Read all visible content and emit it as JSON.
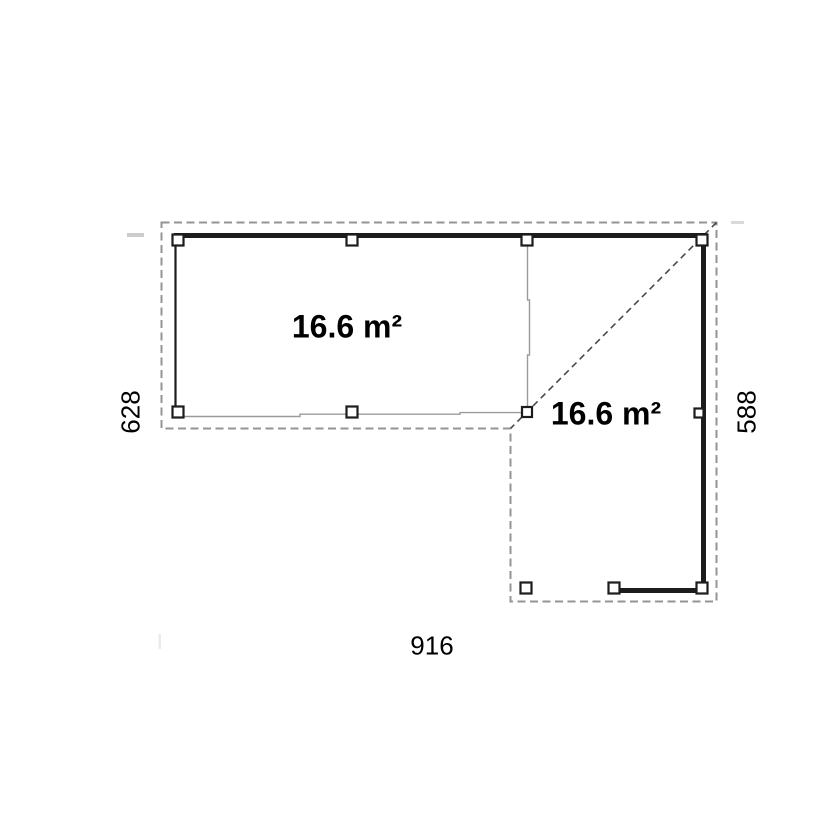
{
  "plan": {
    "area_labels": [
      {
        "text": "16.6 m²"
      },
      {
        "text": "16.6 m²"
      }
    ],
    "dimensions": {
      "bottom_width": "916",
      "left_height": "628",
      "right_height": "588"
    },
    "colors": {
      "wall": "#1c1c1c",
      "boundary_dash": "#949494",
      "diagonal_dash": "#4a4a4a",
      "thin_line": "#9b9b9b",
      "post_fill": "#ffffff",
      "text": "#000000",
      "background": "#ffffff"
    }
  }
}
